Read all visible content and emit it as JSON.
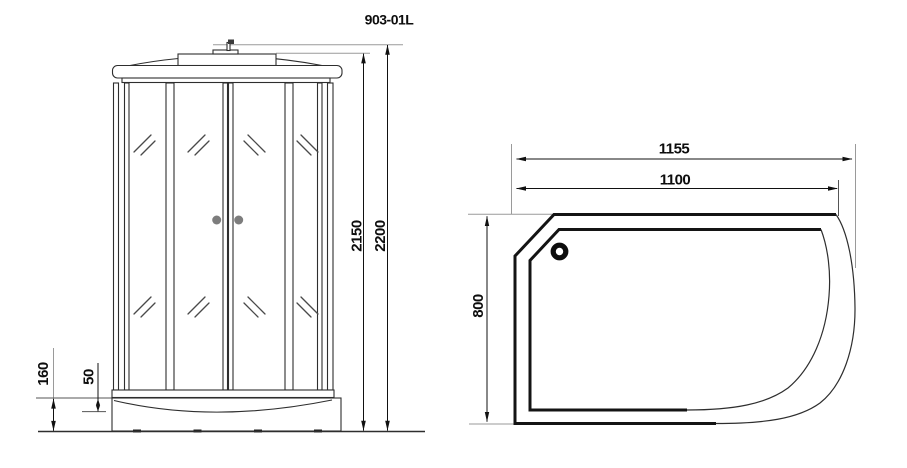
{
  "title": "903-01L",
  "front_view": {
    "dimensions": {
      "cabin_height": "2150",
      "total_height": "2200",
      "tray_height": "160",
      "tray_step": "50"
    }
  },
  "plan_view": {
    "dimensions": {
      "overall_width": "1155",
      "door_width": "1100",
      "depth": "800"
    }
  },
  "colors": {
    "line": "#1a1a1a",
    "extension_line": "#9a9a9a",
    "handle": "#7d7d7d",
    "background": "#ffffff"
  }
}
